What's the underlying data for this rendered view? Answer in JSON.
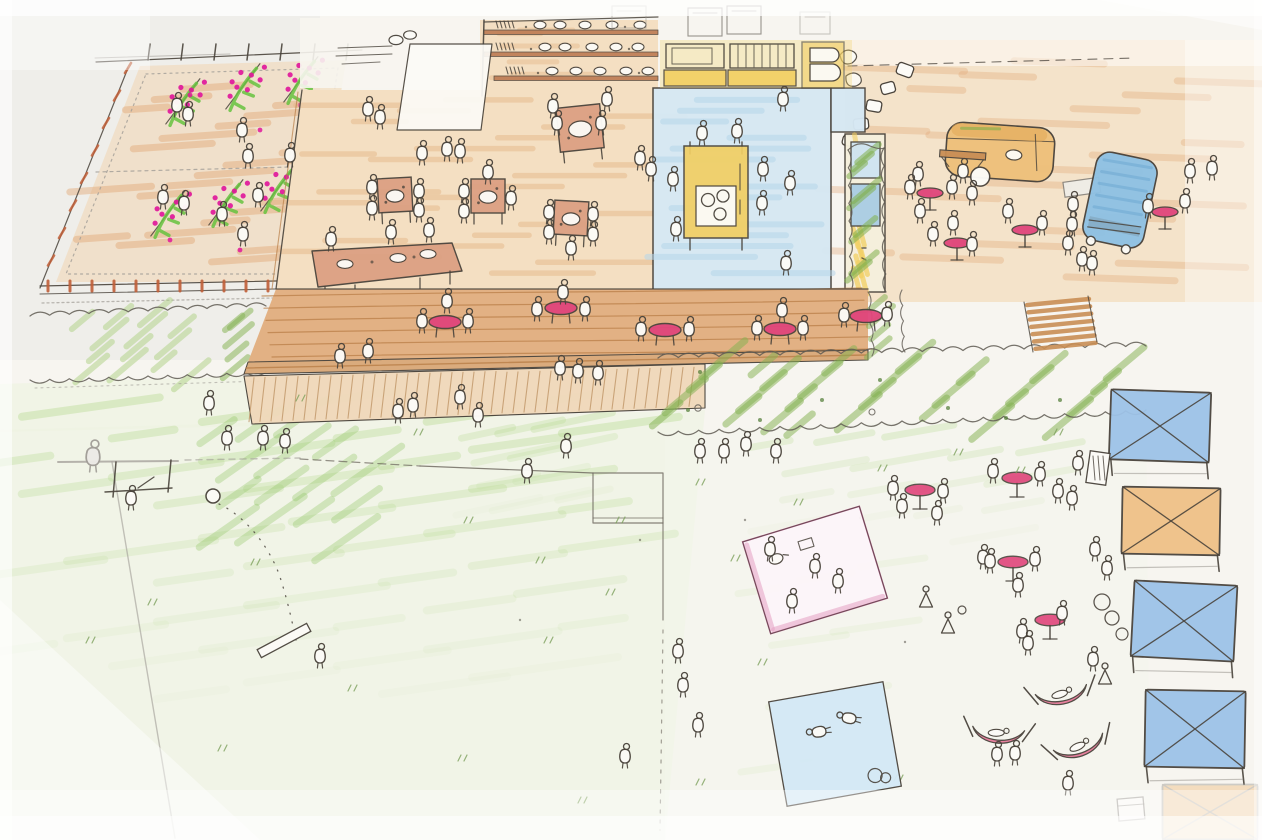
{
  "meta": {
    "description": "Hand-drawn aerial site-plan sketch in ink and colored pencil showing a community park event space: a fenced vegetable garden with magenta flowering rows, a market terrace with square tables and produce shelves, an indoor hall with blue floor and yellow furniture, a food-truck plaza with bistro tables, a long wooden deck with round pink cafe tables, a boardwalk, hedgerows, open lawns with people, picnic blankets, pink hammocks and a row of blue and orange canopy tents."
  },
  "palette": {
    "paper": "#f7f5f0",
    "paper_bright": "#fcfbf7",
    "ink": "#4a443c",
    "pencil": "#a19d97",
    "soil": "#f0d6b0",
    "soil_stroke": "#e2a876",
    "plant_green": "#66c23f",
    "flower_magenta": "#e0189b",
    "hedge_light": "#aed184",
    "hedge_dark": "#82b14f",
    "hedge_ink": "#5f5a52",
    "grass_ink": "#7da05b",
    "lawn_fill": "#edf3e0",
    "lawn_stroke": "#b4d98c",
    "lawn_dark": "#8cc35e",
    "deck_light": "#f4dfc2",
    "deck_light_stroke": "#e5b88a",
    "deck_mid": "#e2b184",
    "deck_step": "#d9a877",
    "plank": "#b97f48",
    "boardwalk": "#f0d9bb",
    "board_stroke": "#c09668",
    "table_top": "#dca083",
    "table_pink": "#e0457b",
    "room_blue": "#d6e8f3",
    "room_stroke": "#b6d6ea",
    "yellow": "#f2cf63",
    "tent_blue": "#9dc3e8",
    "tent_orange": "#efc187",
    "blanket_pink": "#e8a8c8",
    "blanket_pink_edge": "#d4518c",
    "blanket_blue": "#d4e9f6",
    "van_blue": "#8fc1e3",
    "truck_tan": "#eec07b",
    "truck_awning": "#c98e55",
    "hammock_pink": "#e87a9a",
    "fence_red": "#c05f38",
    "shelf_brown": "#c08058",
    "plaza_tan": "#f2d9b5",
    "plaza_stroke": "#ead0a4"
  },
  "scene": {
    "areas": [
      "vegetable-garden",
      "market-terrace",
      "indoor-hall",
      "food-truck-plaza",
      "deck-terrace",
      "boardwalk",
      "hedgerows",
      "lawn",
      "picnic-blankets",
      "hammock-grove",
      "event-tents"
    ],
    "counts": {
      "tents": 5,
      "hammocks": 3,
      "picnic_blankets": 2,
      "vehicles": 2,
      "garden_rows": 6
    },
    "people": [
      [
        177,
        104
      ],
      [
        188,
        113
      ],
      [
        242,
        129
      ],
      [
        248,
        155
      ],
      [
        290,
        154
      ],
      [
        163,
        196
      ],
      [
        184,
        202
      ],
      [
        222,
        213
      ],
      [
        243,
        233
      ],
      [
        258,
        194
      ],
      [
        368,
        108
      ],
      [
        380,
        116
      ],
      [
        422,
        152
      ],
      [
        447,
        148
      ],
      [
        460,
        150
      ],
      [
        553,
        105
      ],
      [
        607,
        98
      ],
      [
        640,
        157
      ],
      [
        372,
        186
      ],
      [
        372,
        207
      ],
      [
        419,
        190
      ],
      [
        419,
        209
      ],
      [
        464,
        190
      ],
      [
        464,
        210
      ],
      [
        511,
        197
      ],
      [
        488,
        171
      ],
      [
        549,
        211
      ],
      [
        549,
        231
      ],
      [
        593,
        213
      ],
      [
        593,
        233
      ],
      [
        571,
        247
      ],
      [
        557,
        122
      ],
      [
        601,
        122
      ],
      [
        331,
        238
      ],
      [
        391,
        231
      ],
      [
        429,
        229
      ],
      [
        702,
        132
      ],
      [
        737,
        130
      ],
      [
        673,
        178
      ],
      [
        763,
        168
      ],
      [
        790,
        182
      ],
      [
        762,
        202
      ],
      [
        676,
        228
      ],
      [
        786,
        262
      ],
      [
        651,
        168
      ],
      [
        783,
        98
      ],
      [
        918,
        173
      ],
      [
        963,
        170
      ],
      [
        972,
        192
      ],
      [
        920,
        210
      ],
      [
        953,
        222
      ],
      [
        933,
        233
      ],
      [
        972,
        243
      ],
      [
        1008,
        210
      ],
      [
        1042,
        222
      ],
      [
        1073,
        203
      ],
      [
        1072,
        223
      ],
      [
        1068,
        242
      ],
      [
        1082,
        258
      ],
      [
        1092,
        262
      ],
      [
        1190,
        170
      ],
      [
        1212,
        167
      ],
      [
        1148,
        205
      ],
      [
        1185,
        200
      ],
      [
        910,
        186
      ],
      [
        952,
        186
      ],
      [
        340,
        355
      ],
      [
        368,
        350
      ],
      [
        560,
        367
      ],
      [
        578,
        370
      ],
      [
        598,
        372
      ],
      [
        422,
        320
      ],
      [
        468,
        320
      ],
      [
        447,
        300
      ],
      [
        537,
        308
      ],
      [
        585,
        308
      ],
      [
        563,
        291
      ],
      [
        641,
        328
      ],
      [
        689,
        328
      ],
      [
        757,
        327
      ],
      [
        803,
        327
      ],
      [
        782,
        309
      ],
      [
        844,
        314
      ],
      [
        887,
        313
      ],
      [
        398,
        410
      ],
      [
        413,
        404
      ],
      [
        460,
        396
      ],
      [
        478,
        414
      ],
      [
        93,
        455,
        "g",
        0,
        1.3
      ],
      [
        131,
        497
      ],
      [
        209,
        402
      ],
      [
        227,
        437
      ],
      [
        263,
        437
      ],
      [
        285,
        440
      ],
      [
        527,
        470
      ],
      [
        566,
        445
      ],
      [
        320,
        655
      ],
      [
        678,
        650
      ],
      [
        683,
        684
      ],
      [
        698,
        724
      ],
      [
        625,
        755
      ],
      [
        700,
        450
      ],
      [
        724,
        450
      ],
      [
        746,
        443
      ],
      [
        776,
        450
      ],
      [
        902,
        505
      ],
      [
        937,
        512
      ],
      [
        983,
        556
      ],
      [
        1018,
        584
      ],
      [
        926,
        598,
        "d"
      ],
      [
        948,
        624,
        "d"
      ],
      [
        1022,
        630
      ],
      [
        893,
        487
      ],
      [
        943,
        490
      ],
      [
        993,
        470
      ],
      [
        1040,
        473
      ],
      [
        990,
        560
      ],
      [
        1035,
        558
      ],
      [
        1028,
        642
      ],
      [
        1062,
        612
      ],
      [
        770,
        548
      ],
      [
        815,
        565
      ],
      [
        838,
        580
      ],
      [
        792,
        600
      ],
      [
        818,
        732,
        "l",
        -100
      ],
      [
        848,
        718,
        "l",
        -80
      ],
      [
        1093,
        658
      ],
      [
        1105,
        675,
        "d"
      ],
      [
        997,
        753
      ],
      [
        1015,
        752
      ],
      [
        1068,
        782
      ],
      [
        1078,
        462
      ],
      [
        1058,
        490
      ],
      [
        1072,
        497
      ],
      [
        1095,
        548
      ],
      [
        1107,
        567
      ]
    ],
    "square_tables": [
      [
        395,
        195,
        -3,
        34
      ],
      [
        488,
        196,
        0,
        34
      ],
      [
        571,
        218,
        3,
        34
      ],
      [
        580,
        128,
        -6,
        44
      ]
    ],
    "round_tables_seated": [
      [
        445,
        322
      ],
      [
        561,
        308
      ],
      [
        665,
        330
      ],
      [
        780,
        329
      ],
      [
        866,
        316
      ]
    ],
    "standing_tables_plaza": [
      [
        930,
        193
      ],
      [
        957,
        243
      ],
      [
        1025,
        230
      ],
      [
        1165,
        212
      ]
    ],
    "standing_tables_lawn": [
      [
        920,
        490
      ],
      [
        1017,
        478
      ],
      [
        1013,
        562
      ],
      [
        1050,
        620
      ]
    ],
    "tents": [
      [
        1160,
        426,
        100,
        70,
        2,
        "blue",
        false
      ],
      [
        1171,
        521,
        98,
        67,
        1,
        "orange",
        false
      ],
      [
        1184,
        621,
        103,
        76,
        3,
        "blue",
        false
      ],
      [
        1195,
        729,
        100,
        77,
        1,
        "blue",
        false
      ],
      [
        1210,
        812,
        95,
        55,
        0,
        "orange",
        true
      ]
    ],
    "hammocks": [
      [
        1062,
        696,
        -10
      ],
      [
        998,
        735,
        6
      ],
      [
        1080,
        748,
        -18
      ]
    ],
    "blankets": [
      [
        815,
        570,
        122,
        96,
        -17,
        "pink"
      ],
      [
        835,
        744,
        116,
        106,
        -10,
        "blue"
      ]
    ],
    "vehicles": {
      "food_truck": [
        1000,
        152,
        4
      ],
      "van": [
        1120,
        200,
        12
      ]
    },
    "garden_rows": [
      [
        165,
        118
      ],
      [
        225,
        103
      ],
      [
        283,
        96
      ],
      [
        150,
        230
      ],
      [
        208,
        219
      ],
      [
        260,
        205
      ]
    ],
    "grass_tufts": [
      [
        300,
        398
      ],
      [
        418,
        432
      ],
      [
        468,
        520
      ],
      [
        255,
        562
      ],
      [
        152,
        602
      ],
      [
        352,
        688
      ],
      [
        548,
        640
      ],
      [
        610,
        592
      ],
      [
        700,
        482
      ],
      [
        735,
        558
      ],
      [
        762,
        662
      ],
      [
        798,
        502
      ],
      [
        958,
        452
      ],
      [
        882,
        468
      ],
      [
        1058,
        432
      ],
      [
        700,
        782
      ],
      [
        462,
        758
      ],
      [
        222,
        748
      ],
      [
        582,
        800
      ],
      [
        898,
        778
      ],
      [
        1020,
        470
      ],
      [
        620,
        520
      ],
      [
        90,
        640
      ],
      [
        540,
        560
      ]
    ]
  }
}
